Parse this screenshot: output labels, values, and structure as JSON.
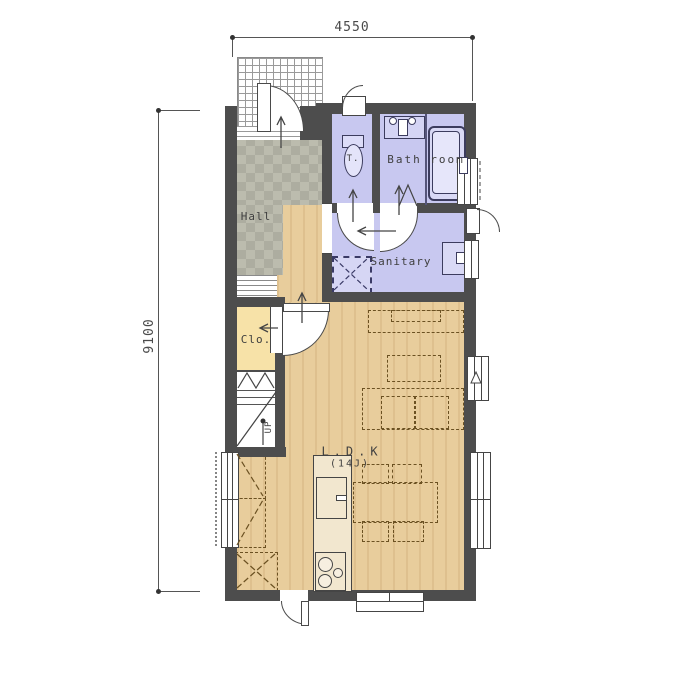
{
  "dimensions": {
    "top": "4550",
    "left": "9100"
  },
  "rooms": {
    "hall": "Hall",
    "toilet": "T.",
    "bathroom": "Bath room",
    "sanitary": "Sanitary",
    "closet": "Clo.",
    "ldk": "L.D.K",
    "ldk_size": "(14J)",
    "stairs_direction": "UP"
  },
  "legend_colors": {
    "wall": "#4d4d4d",
    "wet_rooms": "#c8c8f0",
    "wood_floor": "#e8cd9c",
    "hall_tile": "#bcbcae",
    "closet_floor": "#f7e2a8",
    "porch_tile": "#ffffff"
  }
}
